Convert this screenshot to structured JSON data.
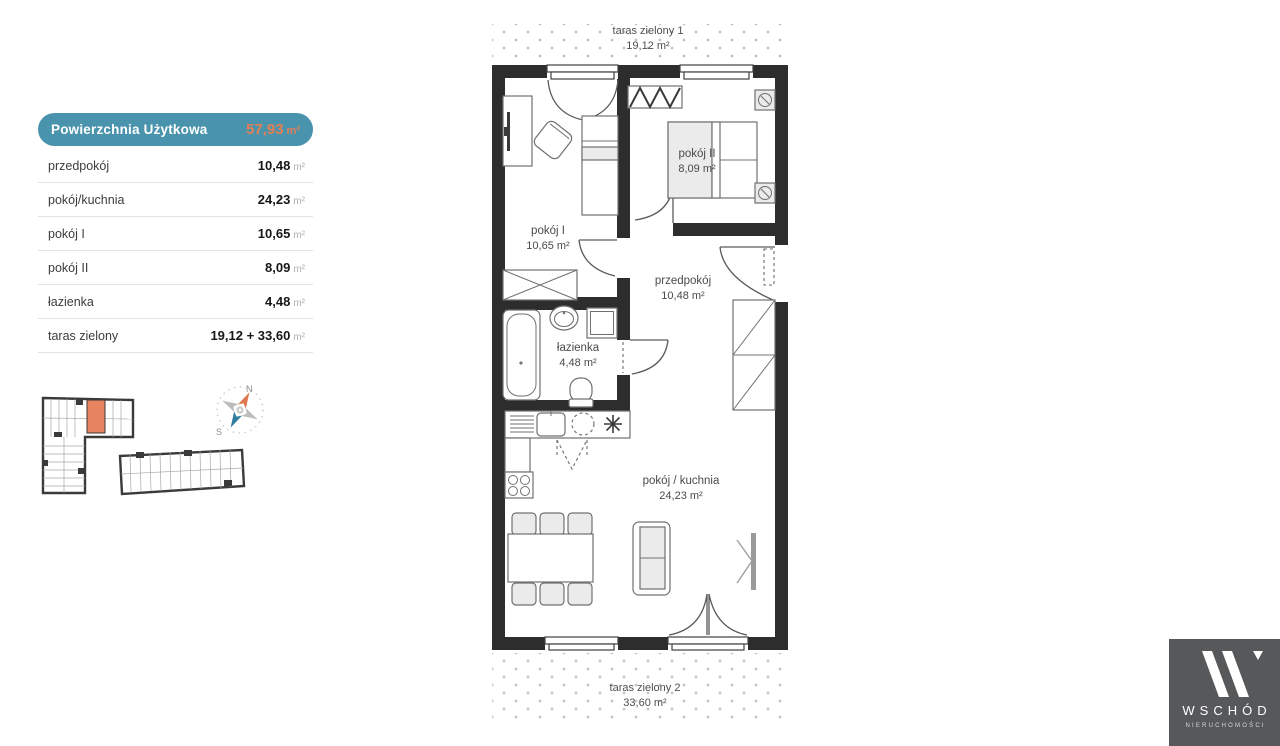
{
  "legend": {
    "header": {
      "label": "Powierzchnia Użytkowa",
      "value": "57,93",
      "unit": "m²"
    },
    "rows": [
      {
        "label": "przedpokój",
        "value": "10,48",
        "unit": "m²"
      },
      {
        "label": "pokój/kuchnia",
        "value": "24,23",
        "unit": "m²"
      },
      {
        "label": "pokój I",
        "value": "10,65",
        "unit": "m²"
      },
      {
        "label": "pokój II",
        "value": "8,09",
        "unit": "m²"
      },
      {
        "label": "łazienka",
        "value": "4,48",
        "unit": "m²"
      },
      {
        "label": "taras zielony",
        "value": "19,12 + 33,60",
        "unit": "m²"
      }
    ]
  },
  "site": {
    "compass": {
      "north": "N",
      "south": "S"
    }
  },
  "plan": {
    "rooms": [
      {
        "name": "pokój I",
        "area": "10,65 m²"
      },
      {
        "name": "pokój II",
        "area": "8,09 m²"
      },
      {
        "name": "przedpokój",
        "area": "10,48 m²"
      },
      {
        "name": "łazienka",
        "area": "4,48 m²"
      },
      {
        "name": "pokój / kuchnia",
        "area": "24,23 m²"
      }
    ],
    "terraces": [
      {
        "name": "taras zielony 1",
        "area": "19,12 m²"
      },
      {
        "name": "taras zielony 2",
        "area": "33,60 m²"
      }
    ]
  },
  "logo": {
    "brand": "WSCHÓD",
    "subtitle": "NIERUCHOMOŚCI"
  },
  "colors": {
    "teal": "#4a93ad",
    "orange": "#e57e53",
    "wall": "#2d2d2d",
    "unit_highlight": "#e8835f"
  }
}
